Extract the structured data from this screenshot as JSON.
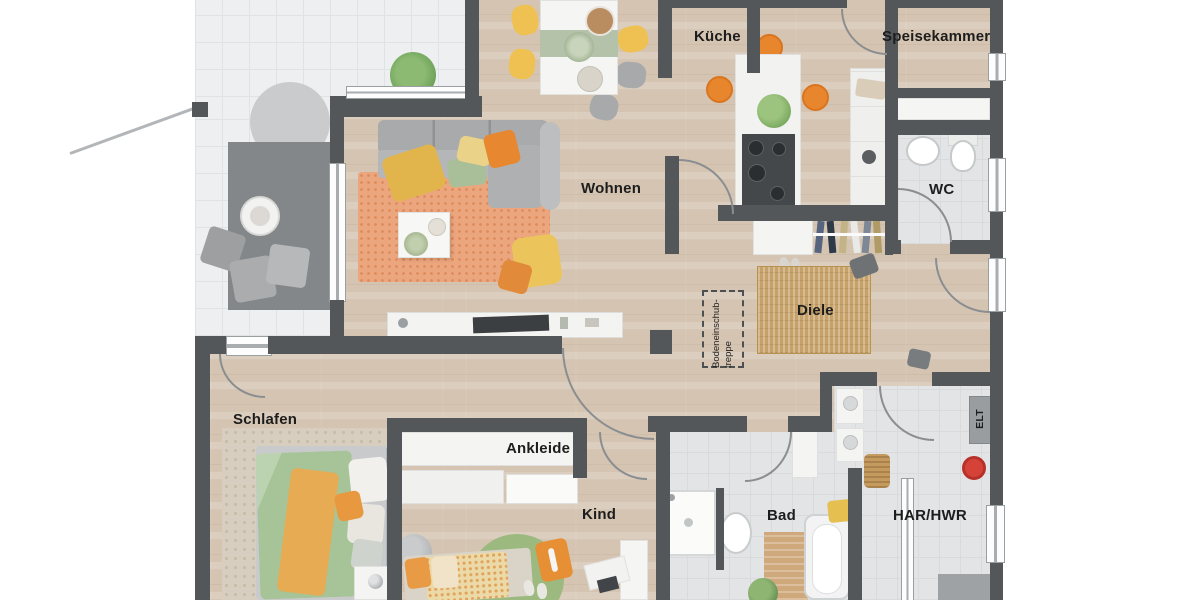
{
  "title": "Grundriss Erdgeschoss (floor plan)",
  "rooms": {
    "kueche": {
      "label": "Küche"
    },
    "speisekammer": {
      "label": "Speisekammer"
    },
    "wc": {
      "label": "WC"
    },
    "wohnen": {
      "label": "Wohnen"
    },
    "diele": {
      "label": "Diele"
    },
    "schlafen": {
      "label": "Schlafen"
    },
    "ankleide": {
      "label": "Ankleide"
    },
    "kind": {
      "label": "Kind"
    },
    "bad": {
      "label": "Bad"
    },
    "har_hwr": {
      "label": "HAR/HWR"
    },
    "elt": {
      "label": "ELT"
    }
  },
  "annotations": {
    "attic_stairs": {
      "line1": "Bodeneinschub-",
      "line2": "treppe"
    }
  },
  "colors": {
    "wall": "#53575a",
    "wood_floor": "#d8c9b7",
    "terrace_tile": "#edeff0",
    "wet_room_floor": "#e2e4e5",
    "accent_orange": "#e8862e",
    "accent_yellow": "#eec152",
    "accent_sage": "#a6c497",
    "living_rug": "#eca67e",
    "hall_rug": "#c6a169",
    "label_text": "#1d1d1d"
  }
}
